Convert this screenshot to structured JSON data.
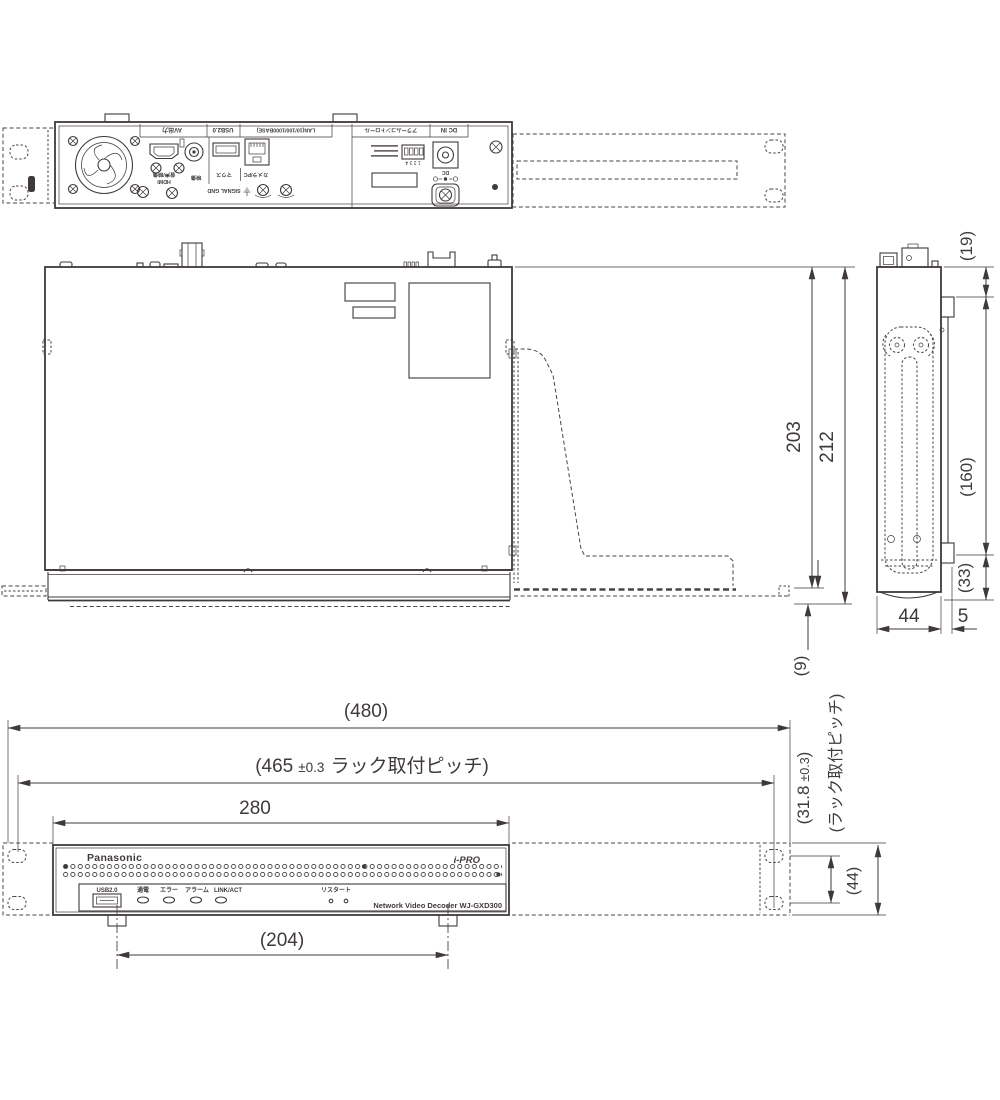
{
  "drawing": {
    "line_color": "#3f3a39",
    "views": [
      "rear",
      "top",
      "side",
      "front"
    ]
  },
  "rear_view": {
    "port_labels": {
      "av_out": "AV出力",
      "usb": "USB2.0",
      "lan": "LAN(10/100/1000BASE)",
      "alarm_control": "アラームコントロール",
      "dc_in": "DC IN",
      "audio_video": "音声/映像",
      "hdmi": "HDMI",
      "video": "映像",
      "mouse": "マウス",
      "camera_pc": "カメラ/PC",
      "signal_gnd": "SIGNAL GND",
      "dip_numbers": "1 2 3 4",
      "dc": "DC"
    }
  },
  "top_view": {
    "dims": {
      "body_depth": "203",
      "total_depth": "212",
      "front_lip": "(9)"
    }
  },
  "side_view": {
    "dims": {
      "top_offset": "(19)",
      "mid_length": "(160)",
      "bottom_offset": "(33)",
      "body_width": "44",
      "rail_offset": "5"
    }
  },
  "front_view": {
    "brand_left": "Panasonic",
    "brand_right": "i-PRO",
    "usb_label": "USB2.0",
    "led_labels": [
      "通電",
      "エラー",
      "アラーム",
      "LINK/ACT"
    ],
    "restart_label": "リスタート",
    "model_label": "Network Video Decoder  WJ-GXD300",
    "dims": {
      "overall_width": "(480)",
      "rack_pitch_value": "(465",
      "rack_pitch_tol": "±0.3",
      "rack_pitch_suffix": "ラック取付ピッチ)",
      "body_width": "280",
      "feet_pitch": "(204)",
      "v_pitch_value": "(31.8",
      "v_pitch_tol": "±0.3",
      "v_pitch_close": ")",
      "v_pitch_note": "(ラック取付ピッチ)",
      "panel_height": "(44)"
    }
  }
}
